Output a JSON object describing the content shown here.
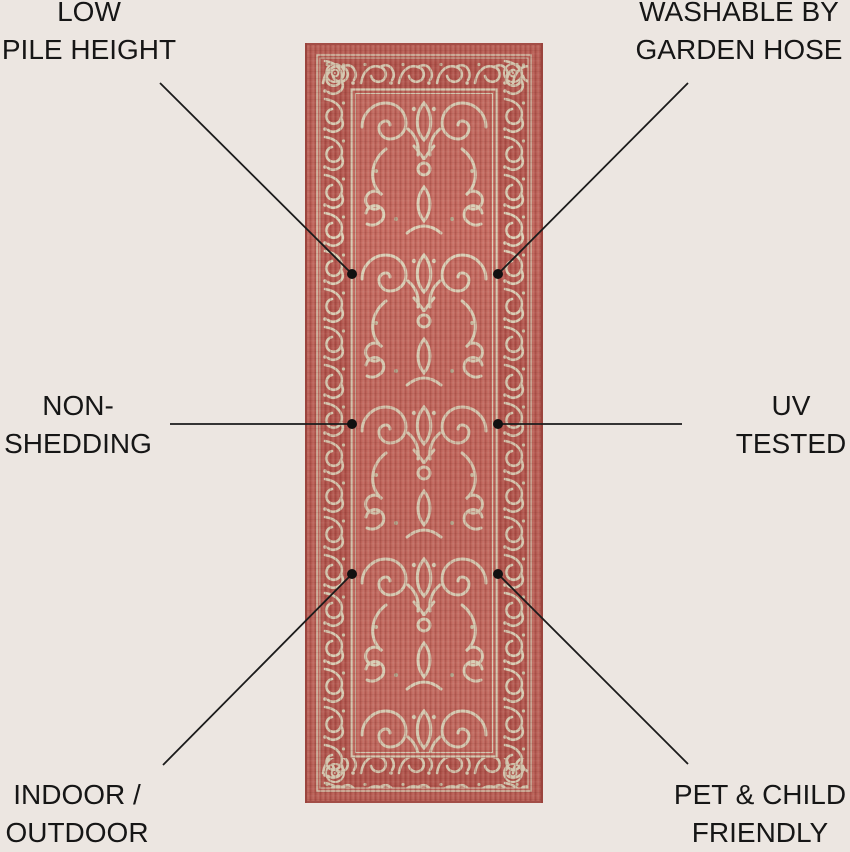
{
  "page": {
    "kind": "product-feature-infographic",
    "background": "#ece6e1"
  },
  "rug": {
    "description": "Red terracotta runner rug with ornate cream scrollwork medallion pattern and scroll border",
    "colors": {
      "base_red": "#bd6057",
      "border_band_red": "#b6574f",
      "field_red": "#c56a60",
      "pattern_cream": "#dbd1b8",
      "pattern_cream_dim": "#cfc4a8",
      "selvedge": "#a34e47"
    }
  },
  "annotation": {
    "line_color": "#1b1b1b",
    "dot_color": "#111111",
    "text_color": "#161616"
  },
  "callouts": [
    {
      "id": "low-pile-height",
      "position": "top-left",
      "line1": "LOW",
      "line2": "PILE HEIGHT"
    },
    {
      "id": "washable",
      "position": "top-right",
      "line1": "WASHABLE BY",
      "line2": "GARDEN HOSE"
    },
    {
      "id": "non-shedding",
      "position": "middle-left",
      "line1": "NON-",
      "line2": "SHEDDING"
    },
    {
      "id": "uv-tested",
      "position": "middle-right",
      "line1": "UV",
      "line2": "TESTED"
    },
    {
      "id": "indoor-outdoor",
      "position": "bottom-left",
      "line1": "INDOOR /",
      "line2": "OUTDOOR"
    },
    {
      "id": "pet-child-friendly",
      "position": "bottom-right",
      "line1": "PET & CHILD",
      "line2": "FRIENDLY"
    }
  ]
}
